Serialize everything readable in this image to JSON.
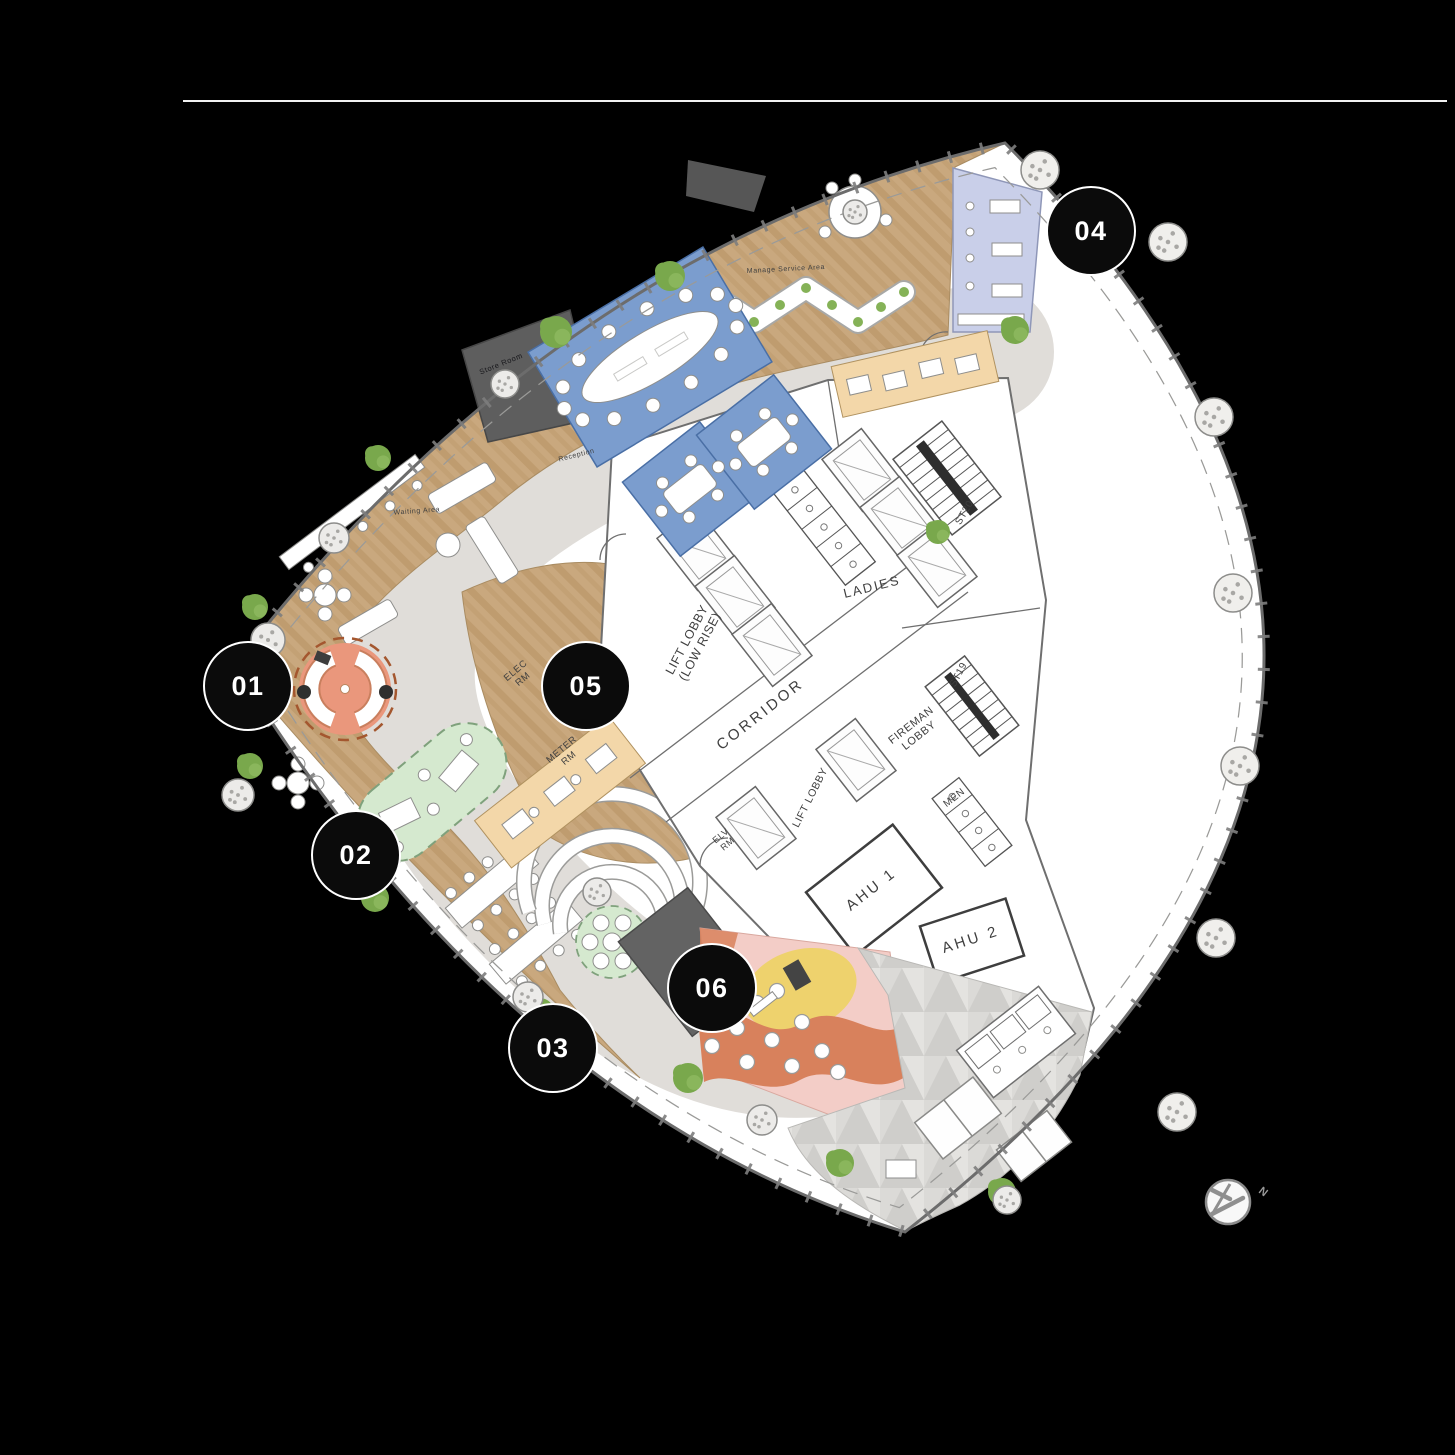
{
  "page": {
    "background": "#000000",
    "rule_color": "#f2f2f2"
  },
  "colors": {
    "background": "#000000",
    "rule": "#f2f2f2",
    "plate": "#ffffff",
    "outline": "#6c6c6c",
    "inner_dash": "#9a9a98",
    "wood": "#c9a87e",
    "wood_stripe": "#bf9c6f",
    "path": "#e0ddd9",
    "blue": "#7b9dce",
    "blue_stroke": "#4a6fa5",
    "lavender": "#c9cfe9",
    "lavender_stroke": "#8f97b8",
    "beige": "#f3d7a9",
    "beige_stroke": "#b09260",
    "dark": "#5e5e5e",
    "green": "#d5e9cf",
    "green_stroke": "#7fa17c",
    "orange_pod": "#ea977c",
    "orange_pod_stroke": "#a4572f",
    "pink": "#f3cdc7",
    "orange": "#d8815c",
    "yellow": "#eed26d",
    "terrace": "#dbdad7",
    "terrace_tri": "#cfcecb",
    "tree": "#79a84c",
    "furn_stroke": "#8e8e8c",
    "wall": "#6f6f6f",
    "label": "#3f3f3f",
    "marker_bg": "#0b0b0b",
    "marker_text": "#ffffff"
  },
  "compass": {
    "label": "N"
  },
  "plan": {
    "markers": [
      {
        "label": "01",
        "x": 248,
        "y": 686
      },
      {
        "label": "02",
        "x": 356,
        "y": 855
      },
      {
        "label": "03",
        "x": 553,
        "y": 1048
      },
      {
        "label": "04",
        "x": 1091,
        "y": 231
      },
      {
        "label": "05",
        "x": 586,
        "y": 686
      },
      {
        "label": "06",
        "x": 712,
        "y": 988
      }
    ],
    "room_labels": [
      {
        "id": "lift-lobby-low-rise",
        "lines": [
          "LIFT LOBBY",
          "(LOW RISE)"
        ],
        "x": 697,
        "y": 645,
        "rot": -62,
        "size": 12.5
      },
      {
        "id": "corridor",
        "lines": [
          "CORRIDOR"
        ],
        "x": 763,
        "y": 718,
        "rot": -38,
        "size": 15,
        "spacing": 3
      },
      {
        "id": "ladies",
        "lines": [
          "LADIES"
        ],
        "x": 873,
        "y": 591,
        "rot": -14,
        "size": 13,
        "spacing": 2
      },
      {
        "id": "fireman-lobby",
        "lines": [
          "FIREMAN",
          "LOBBY"
        ],
        "x": 917,
        "y": 733,
        "rot": -38,
        "size": 11
      },
      {
        "id": "lift-lobby",
        "lines": [
          "LIFT LOBBY"
        ],
        "x": 813,
        "y": 799,
        "rot": -63,
        "size": 10.5
      },
      {
        "id": "elv-rm",
        "lines": [
          "ELV",
          "RM"
        ],
        "x": 726,
        "y": 842,
        "rot": -40,
        "size": 9
      },
      {
        "id": "elec-rm",
        "lines": [
          "ELEC",
          "RM"
        ],
        "x": 521,
        "y": 677,
        "rot": -40,
        "size": 9.5
      },
      {
        "id": "meter-rm",
        "lines": [
          "METER",
          "RM"
        ],
        "x": 567,
        "y": 756,
        "rot": -40,
        "size": 9.5
      },
      {
        "id": "ahu-1",
        "lines": [
          "AHU 1"
        ],
        "x": 874,
        "y": 893,
        "rot": -38,
        "size": 15,
        "spacing": 3
      },
      {
        "id": "ahu-2",
        "lines": [
          "AHU 2"
        ],
        "x": 972,
        "y": 944,
        "rot": -18,
        "size": 15,
        "spacing": 3
      },
      {
        "id": "st20",
        "lines": [
          "ST20"
        ],
        "x": 967,
        "y": 514,
        "rot": -60,
        "size": 10
      },
      {
        "id": "st19",
        "lines": [
          "ST19"
        ],
        "x": 961,
        "y": 676,
        "rot": -62,
        "size": 10
      },
      {
        "id": "men",
        "lines": [
          "MEN"
        ],
        "x": 956,
        "y": 800,
        "rot": -38,
        "size": 10
      },
      {
        "id": "store-room",
        "lines": [
          "Store Room"
        ],
        "x": 502,
        "y": 366,
        "rot": -22,
        "size": 7.5,
        "color": "#16161a"
      },
      {
        "id": "reception",
        "lines": [
          "Reception"
        ],
        "x": 577,
        "y": 457,
        "rot": -14,
        "size": 7
      },
      {
        "id": "waiting-area",
        "lines": [
          "Waiting Area"
        ],
        "x": 417,
        "y": 513,
        "rot": -4,
        "size": 7
      },
      {
        "id": "manage-service-area",
        "lines": [
          "Manage Service Area"
        ],
        "x": 786,
        "y": 271,
        "rot": -3,
        "size": 7
      }
    ],
    "trees": [
      [
        556,
        332,
        16
      ],
      [
        670,
        276,
        15
      ],
      [
        1015,
        330,
        14
      ],
      [
        378,
        458,
        13
      ],
      [
        255,
        607,
        13
      ],
      [
        250,
        766,
        13
      ],
      [
        375,
        898,
        14
      ],
      [
        540,
        1012,
        14
      ],
      [
        688,
        1078,
        15
      ],
      [
        840,
        1163,
        14
      ],
      [
        1002,
        1192,
        14
      ],
      [
        938,
        532,
        12
      ]
    ],
    "columns": [
      [
        1168,
        242
      ],
      [
        1214,
        417
      ],
      [
        1233,
        593
      ],
      [
        1240,
        766
      ],
      [
        1216,
        938
      ],
      [
        1177,
        1112
      ],
      [
        1040,
        170
      ]
    ],
    "planters": [
      [
        268,
        640,
        17
      ],
      [
        238,
        795,
        16
      ],
      [
        334,
        538,
        15
      ],
      [
        528,
        997,
        15
      ],
      [
        597,
        892,
        14
      ],
      [
        762,
        1120,
        15
      ],
      [
        1007,
        1200,
        14
      ],
      [
        505,
        384,
        14
      ],
      [
        855,
        212,
        12
      ]
    ],
    "lifts": [
      [
        697,
        549
      ],
      [
        735,
        597
      ],
      [
        772,
        645
      ],
      [
        862,
        470
      ],
      [
        900,
        518
      ],
      [
        937,
        566
      ],
      [
        756,
        828
      ],
      [
        856,
        760
      ]
    ],
    "stairs": [
      {
        "x": 947,
        "y": 478,
        "rot": -38,
        "w": 62,
        "h": 96,
        "treads": 9
      },
      {
        "x": 972,
        "y": 706,
        "rot": -38,
        "w": 50,
        "h": 88,
        "treads": 8
      }
    ],
    "toilets": [
      {
        "x": 824,
        "y": 527,
        "rot": -38,
        "w": 38,
        "h": 118,
        "stalls": 5
      },
      {
        "x": 972,
        "y": 822,
        "rot": -38,
        "w": 34,
        "h": 86,
        "stalls": 4
      }
    ],
    "chair_rings": [
      {
        "cx": 650,
        "cy": 357,
        "rot": -31,
        "rx": 100,
        "ry": 44,
        "n": 14,
        "r": 7
      },
      {
        "cx": 690,
        "cy": 489,
        "rot": -38,
        "rx": 36,
        "ry": 25,
        "n": 6,
        "r": 6
      },
      {
        "cx": 764,
        "cy": 442,
        "rot": -38,
        "rx": 36,
        "ry": 25,
        "n": 6,
        "r": 6
      }
    ],
    "stools": [
      [
        737,
        1028
      ],
      [
        757,
        1003
      ],
      [
        772,
        1040
      ],
      [
        792,
        1066
      ],
      [
        802,
        1022
      ],
      [
        822,
        1051
      ],
      [
        747,
        1062
      ],
      [
        712,
        1046
      ],
      [
        777,
        991
      ],
      [
        838,
        1072
      ]
    ],
    "zigzag_dots": [
      [
        650,
        322
      ],
      [
        676,
        305
      ],
      [
        702,
        288
      ],
      [
        728,
        305
      ],
      [
        754,
        322
      ],
      [
        780,
        305
      ],
      [
        806,
        288
      ],
      [
        832,
        305
      ],
      [
        858,
        322
      ],
      [
        881,
        307
      ],
      [
        904,
        292
      ]
    ]
  }
}
